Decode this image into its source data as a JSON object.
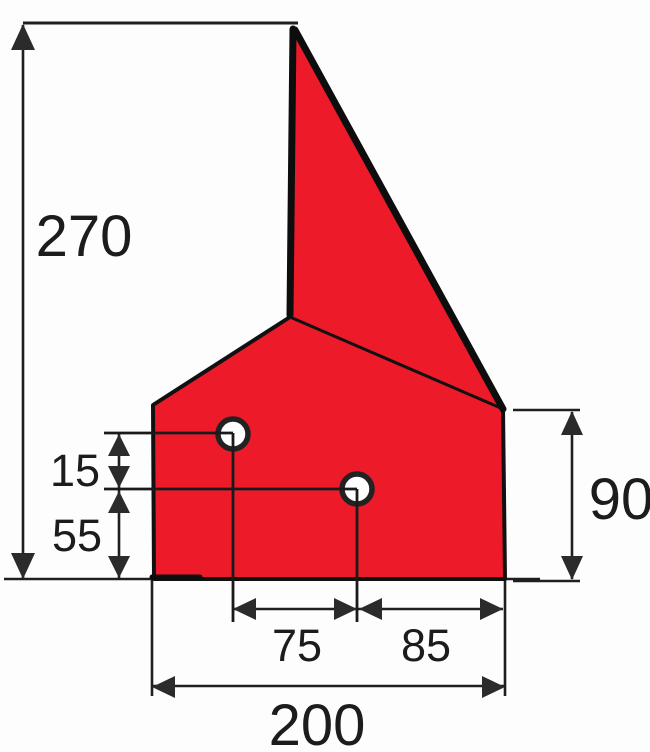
{
  "drawing": {
    "kind": "technical-part-drawing",
    "colors": {
      "part_fill": "#ed1a2a",
      "outline": "#111111",
      "thick_edge": "#0d0d0d",
      "dimension_line": "#1f1f1f",
      "arrow": "#2b2b2b",
      "text": "#1c1c1c",
      "hole_fill": "#ffffff",
      "hole_ring": "#222222",
      "background": "#fdfdfd"
    },
    "dimensions": {
      "overall_height": "270",
      "hole_vertical_spacing": "15",
      "lower_hole_to_base": "55",
      "right_side_height": "90",
      "hole_horizontal_spacing": "75",
      "hole_to_right_edge": "85",
      "base_width": "200"
    }
  }
}
